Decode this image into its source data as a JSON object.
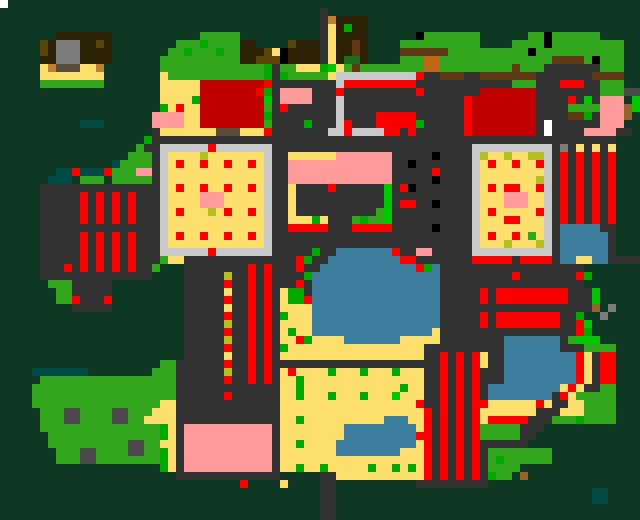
{
  "app": {
    "name": "pixel-art-world-map",
    "width": 640,
    "height": 520
  },
  "map": {
    "cols": 80,
    "rows": 65,
    "cell_size": 8,
    "palette": {
      ".": "#0e3824",
      "G": "#33a81e",
      "g": "#00a800",
      "h": "#00c800",
      "f": "#1e6e1e",
      "t": "#004b46",
      "K": "#333333",
      "k": "#4b4b4b",
      "S": "#7d7d7d",
      "C": "#c9c9c9",
      "W": "#ffffff",
      "B": "#000000",
      "R": "#fa0000",
      "r": "#c00000",
      "P": "#ff9b9b",
      "Y": "#fddf6d",
      "y": "#b4be1e",
      "O": "#5a4708",
      "N": "#2e2206",
      "n": "#5f3a14",
      "o": "#c08030",
      "c": "#c06818",
      "b": "#96642d",
      "q": "#5a4d3c",
      "L": "#3d7d9e"
    },
    "pixels": [
      "W1 .79",
      ".40 K1 .39",
      ".40 K1 o1 N4 .34",
      ".40 K1 Y1 N1 g1 N2 .34",
      ".7 N7 .11 G5 .10 K1 Y1 N4 .6 B1 G7 .6 G2 B1 G6 .5",
      ".5 O1 N1 S3 N2 O1 N1 .8 G3 g1 G4 N2 .4 O1 N3 K1 Y1 N2 n1 N1 .4 G10 .4 G4 B1 G9 .2",
      ".5 O1 N1 S3 N4 .7 G2 g1 G3 g1 G2 N3 O1 Y1 B1 N4 K1 Y1 N2 n1 N1 .4 n6 G10 B1 G11 .2",
      ".5 N2 S3 N4 .6 G10 N2 O3 B1 N4 K1 Y1 N1 f2 N1 .4 G3 c2 G14 n4 G1 B1 G3 .2",
      ".5 Y1 o1 q3 Y2 o1 .7 G13 g1 K1 G2 Y3 g1 h1 Y1 G1 n1 G8 c2 G9 n1 G3 K7 G3 .2",
      ".5 Y8 .7 Y1 G12 g1 K1 g1 G5 Y1 C10 R1 K2 n3 K2 n7 K7 n4 .2",
      ".5 G8 .7 Y5 r8 R1 K8 C1 R9 K12 G3 K3 R3 K2 G3 .2",
      ".20 Y5 r7 R1 g1 K1 P4 K3 R1 K9 R1 K7 r7 K8 G3 k2",
      ".20 Y4 g1 r8 h1 K1 P4 K3 C1 K15 R1 r8 K4 R1 K1 h1 K1 P3 .1 h1",
      ".20 g1 Y1 R1 Y2 r8 G1 K1 R1 K6 C1 K15 R1 r8 K4 G4 P3 b1 h1",
      ".19 P4 Y2 r8 g1 K8 C1 K4 R5 K6 R1 r8 K4 n2 g1 K1 P3 b1 .1",
      ".10 t3 .6 P4 Y2 r8 G1 K4 g1 K3 C1 R1 K3 R5 g1 K5 R1 r8 K1 W1 K6 P3 .2",
      ".19 K1 Y7 q3 Y3 R1 K7 C2 R1 C4 R2 K1 R1 K6 R1 r8 K1 W1 K4 P4 K2 .1",
      ".18 g1 K58 .3",
      ".17 G1 K2 C6 R1 C7 K25 C10 K1 S1 K1 Y1 K1 Y1 K1 Y1 .3",
      ".16 G3 K1 C1 Y4 y1 Y7 C1 K2 Y6 P7 K5 B1 K4 C1 y1 Y2 y1 Y2 y2 C1 K1 R1 K1 R1 K1 R1 K1 R1 .3",
      ".14 t1 G4 K1 C1 Y1 R1 Y2 R1 Y2 R1 Y2 R1 Y1 C1 K2 P13 K2 B1 K7 C1 Y1 R1 Y2 R1 Y2 R1 C1 K1 R1 K1 R1 K1 R1 K1 R1 .3",
      ".7 t2 R1 t3 R1 G3 P2 K1 C1 Y12 C1 K2 P13 K5 R1 K4 C1 Y8 C1 K1 R1 K1 R1 K1 R1 K1 R1 .3",
      ".6 t3 .1 G3 .1 G5 K1 C1 Y12 C1 K2 P13 K5 B1 K4 C1 Y7 y1 C1 K1 R1 K1 R1 K1 R1 K1 R1 .3",
      ".5 K15 C1 Y1 R1 Y2 R1 Y2 R1 Y2 R1 Y1 C1 K2 Y1 K4 R1 K6 h1 K1 R1 B1 K7 C1 Y1 R1 Y1 R2 Y2 R1 C1 K1 R1 K1 R1 K1 R1 K1 R1 .3",
      ".5 K5 R1 K1 R1 K1 R1 K1 R1 K3 C1 Y4 P3 Y5 C1 K2 Y1 K11 h1 K10 C1 Y3 P3 Y2 C1 K1 R1 K1 R1 K1 R1 K1 R1 .3",
      ".5 K5 R1 K1 R1 K1 R1 K1 R1 K3 C1 Y4 P3 Y5 C1 K2 Y1 K11 h1 K1 R2 K2 B1 K4 C1 Y3 P3 Y2 C1 K1 R1 K1 R1 K1 R1 K1 R1 .3",
      ".5 K5 R1 K1 R1 K1 R1 K1 R1 K3 C1 Y1 R1 Y3 y1 Y1 R1 Y2 R1 Y1 C1 K2 Y1 K10 G1 h1 K10 C1 Y1 R1 Y5 R1 C1 K1 R1 K1 R1 K1 R1 K1 R1 .3",
      ".5 K5 R1 K1 R1 K1 R1 K1 R1 K3 C1 Y12 C1 K2 Y3 g1 Y1 K3 G1 g1 G2 h1 K10 C1 Y3 R2 Y3 C1 K1 R1 K1 R1 K1 R1 K1 R1 .3",
      ".5 K15 C1 Y12 C1 K2 R5 K3 R5 K5 B1 K4 C1 Y8 C1 K1 L5 K2 .3",
      ".5 K5 R1 K1 R1 K1 R1 K1 R1 K3 C1 Y1 R1 Y2 R1 Y2 R1 Y2 R1 Y1 C1 K25 C1 Y1 R1 Y2 R1 Y1 G1 Y1 C1 K1 L6 K1 .3",
      ".5 K5 R1 K1 R1 K1 R1 K1 R1 K3 C1 Y12 C1 K25 C1 Y3 y1 Y3 y1 C1 K1 L6 K1 .3",
      ".5 K5 R1 K1 R1 K1 R1 K1 R1 K3 C6 R1 C7 K5 g1 K2 L7 R1 K2 P2 K5 C10 K1 L6 K1 .3",
      ".5 K5 R1 K1 R1 K1 R1 K1 R1 K3 G1 Y2 K14 R1 g1 K2 L9 R2 K7 R5 K1 R4 K1 L2 Y2 L2 K4",
      ".5 K3 R1 K1 R1 K1 R1 K1 R1 K1 R1 K2 G1 .3 K8 R1 K1 R1 K3 R1 K2 L12 R1 g1 L1 K18 .7",
      ".5 K14 .4 K5 y1 K2 R1 K1 R1 K4 g1 L16 K9 R1 K7 R1 g1 .6",
      ".6 G3 K5 .9 K5 R1 K2 R1 K1 R1 K3 R1 K1 L16 K18 .7",
      ".7 G2 K5 .9 K5 Y1 K2 R1 K1 R1 K1 Y1 g2 K1 L16 K5 R1 K1 R9 K3 h1 .5",
      ".7 G2 R1 K3 R1 .9 K5 R1 K2 R1 K1 R1 K1 Y1 g2 R1 L16 K5 R1 K1 R9 K3 h1 .5",
      ".9 K5 .9 K5 Y1 K2 R1 K1 R1 K1 Y4 L16 K19 b1 .1 S1 .3",
      ".23 K5 R1 K2 R1 K1 R1 K1 g1 Y3 L16 K5 R1 K1 R8 K2 g1 .2 S1 .4",
      ".23 K5 y1 K2 R1 K1 R1 K1 Y4 L16 K5 R1 K1 R8 K2 R1 h1 .6",
      ".23 K5 R1 K2 R1 K1 R1 K1 Y1 g1 Y2 L15 Y1 K17 R1 g1 .6",
      ".23 K5 y1 K2 R1 K1 R1 K1 Y2 R1 g1 Y4 L7 Y5 K8 L7 K1 G1 h3 .5",
      ".23 K5 R1 K2 R1 K1 R1 K1 g1 Y17 K10 L7 K3 G4 .3",
      ".23 K5 Y1 K2 R1 K1 R1 K1 Y18 K2 R1 K1 R1 K1 R1 Y1 K2 L9 R1 Y1 K1 R2 .3",
      ".20 G2 K6 R1 K2 R1 K1 R1 K21 R1 K1 R1 K1 R1 Y1 K2 L9 R1 Y1 K1 R2 .3",
      ".4 t7 .8 G3 K6 y1 K2 R1 K1 R1 K1 Y1 R1 Y4 g1 Y3 g1 Y3 g1 Y3 K2 R1 K1 R1 K1 R1 K3 L9 R1 Y1 K1 R2 .3",
      ".5 G17 K6 R1 K2 R1 K1 R1 K1 Y2 g1 Y15 K2 R1 K1 R1 K1 R1 K3 L9 R1 Y1 K1 R2 .3",
      ".4 G18 K13 Y2 g1 Y12 g1 Y2 K2 R1 K1 R1 K1 R1 K1 L9 Y1 R1 Y1 K2 G2 .3",
      ".4 G18 K6 R1 K6 Y2 g1 Y3 g1 Y3 g1 Y3 h1 Y3 K2 R1 K1 R1 K1 R1 K1 L8 K1 R1 Y1 G5 .3",
      ".4 G16 Y2 K13 Y17 R1 K2 R1 K1 R1 K1 R1 R1 Y6 R1 Y1 K2 Y2 G4 .3",
      ".5 G3 k2 G4 k2 G3 Y3 K13 Y18 R1 K1 R1 K1 R1 K1 R1 Y7 K3 Y3 G4 .3",
      ".5 G3 k2 G4 k2 G2 Y4 K13 Y2 g1 Y10 L3 Y2 R1 K1 R1 K1 R1 K1 R1 Y1 R5 K3 G3 g1 G4 .3",
      ".5 G15 g1 Y1 K1 P11 K1 Y8 L9 Y1 R1 K1 R1 K1 R1 K1 R1 G5 K3 .12",
      ".6 G14 g1 Y1 K1 P11 K1 Y8 L9 R2 K1 R1 K1 R1 K1 R1 G5 K2 .13",
      ".6 G10 k2 G2 Y2 K1 P11 K1 Y2 g1 Y4 L10 Y1 R1 K1 R1 K1 R1 K1 R1 K6 .14",
      ".7 G3 k2 G4 k2 G2 g1 Y1 K1 P11 K1 Y7 L8 Y3 R1 K1 R1 K1 R1 K1 R1 K1 G8 .11",
      ".7 G3 k2 G8 g1 Y1 K1 P11 K1 Y18 R1 K1 R1 K1 R1 K1 R1 K1 G1 g1 G6 .11",
      ".20 g1 Y1 K1 P11 K1 Y2 g1 Y2 g1 Y5 g1 Y2 g1 Y1 g1 Y1 R1 K1 R1 K1 R1 K1 R1 K1 G4 .15",
      ".22 K13 .5 K2 Y11 R1 K1 R1 K1 R1 K1 R1 K1 g1 G2 .1 b1 .14",
      ".30 R1 .4 Y1 .4 K2 .10 K9 .19",
      ".40 K2 .32 t2 .4",
      ".40 K2 .32 t2 .4",
      ".40 K2 .38",
      ".40 K2 .38"
    ]
  }
}
